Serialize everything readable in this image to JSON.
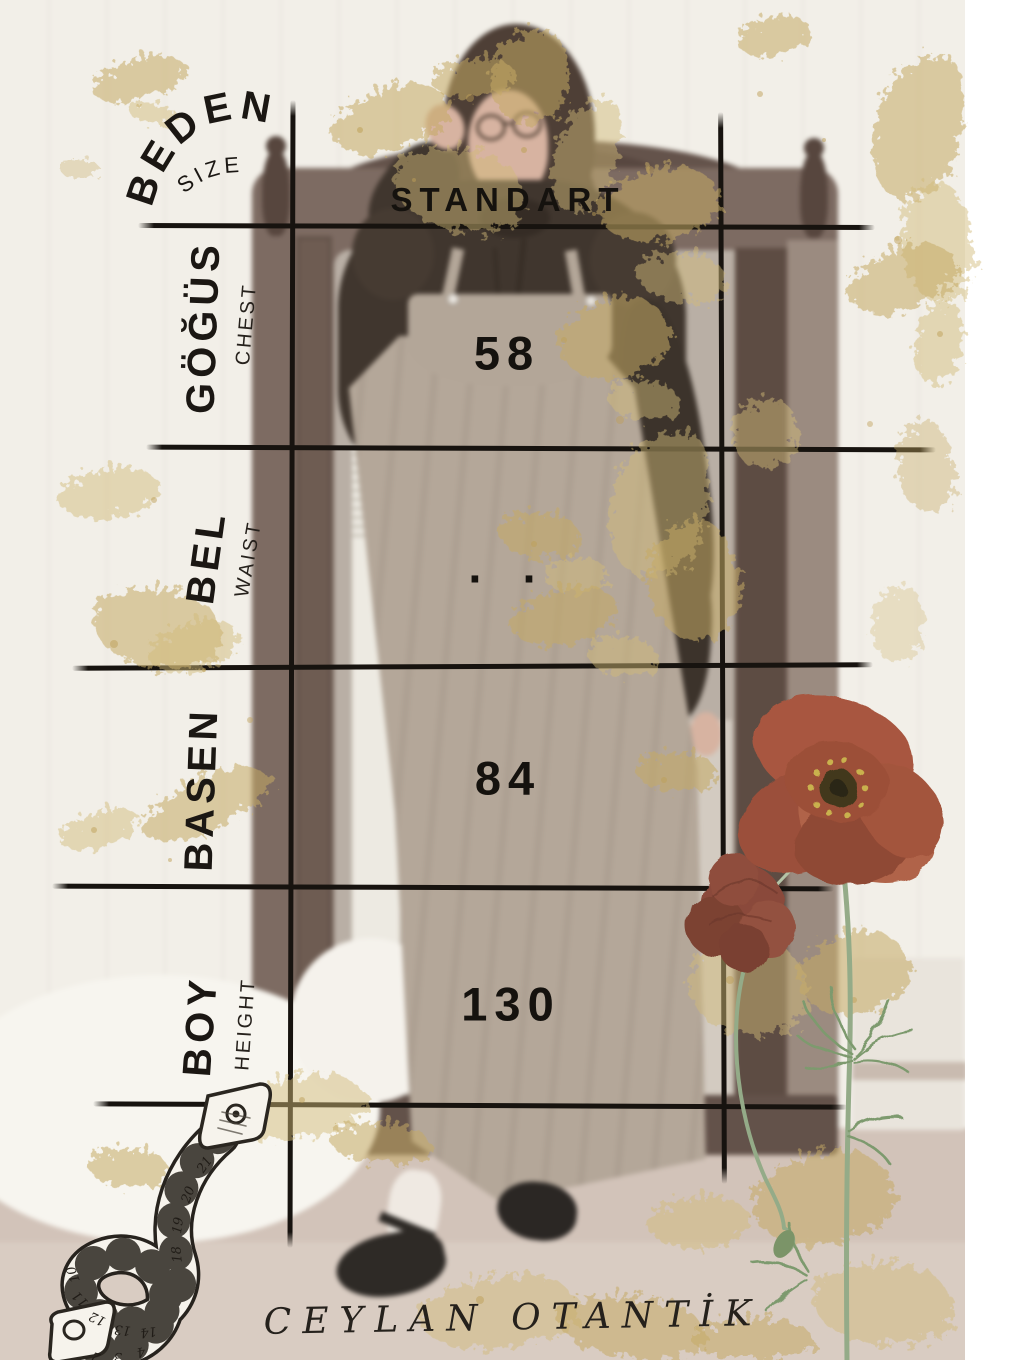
{
  "table": {
    "rows": [
      {
        "label_tr": "BEDEN",
        "label_en": "SIZE",
        "value": "STANDART"
      },
      {
        "label_tr": "GÖĞÜS",
        "label_en": "CHEST",
        "value": "58"
      },
      {
        "label_tr": "BEL",
        "label_en": "WAIST",
        "value": ". ."
      },
      {
        "label_tr": "BASEN",
        "label_en": "",
        "value": "84"
      },
      {
        "label_tr": "BOY",
        "label_en": "HEIGHT",
        "value": "130"
      }
    ]
  },
  "brand": {
    "name": "CEYLAN OTANTİK"
  },
  "chart_data": {
    "type": "table",
    "columns": [
      "",
      "STANDART"
    ],
    "rows": [
      [
        "BEDEN (SIZE)",
        "STANDART"
      ],
      [
        "GÖĞÜS (CHEST)",
        "58"
      ],
      [
        "BEL (WAIST)",
        ". ."
      ],
      [
        "BASEN",
        "84"
      ],
      [
        "BOY (HEIGHT)",
        "130"
      ]
    ]
  },
  "decor": {
    "tape_icon": "measuring-tape-sketch",
    "flowers_icon": "poppy-flowers",
    "splatter": "gold-paint-splatter"
  },
  "colors": {
    "ink": "#1b1713",
    "gold": "#c6a963",
    "poppy": "#a2563f",
    "stem": "#8fa683",
    "background": "#f1eee7",
    "dress": "#b5a89b"
  }
}
